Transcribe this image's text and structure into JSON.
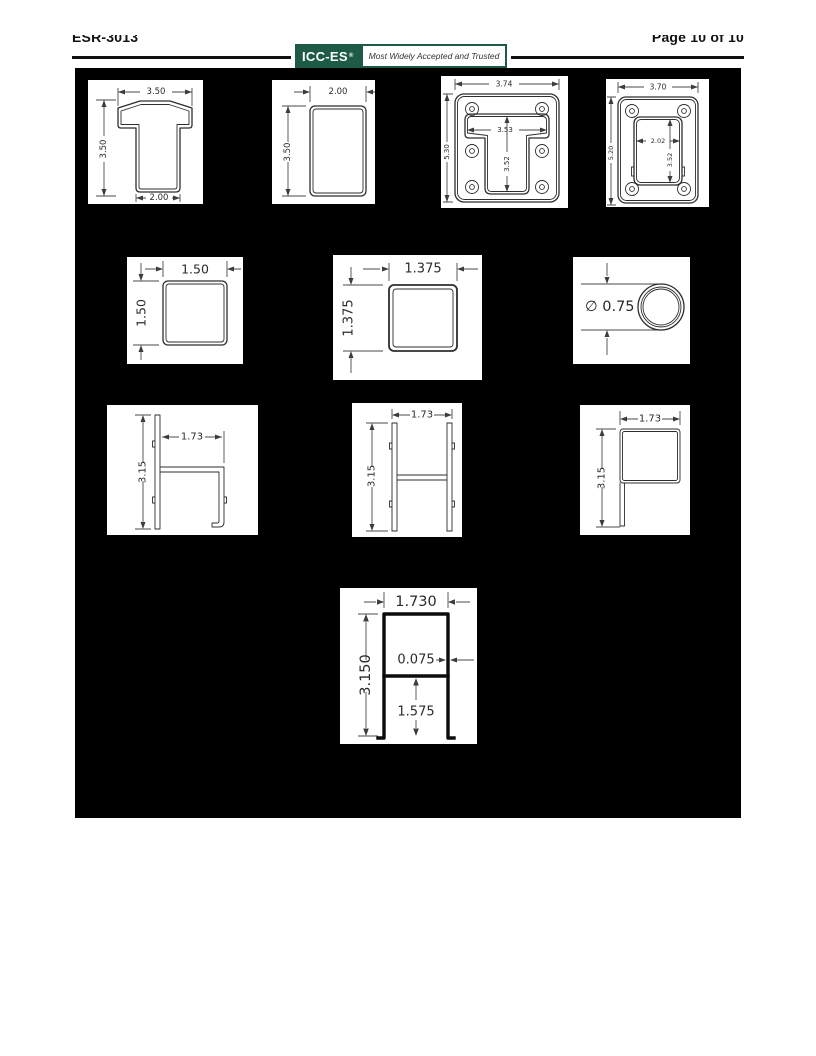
{
  "header": {
    "report_number": "ESR-3013",
    "page_label": "Page 10 of 10",
    "logo_text": "ICC-ES",
    "logo_reg": "®",
    "logo_tagline": "Most Widely Accepted and Trusted"
  },
  "colors": {
    "logo_green": "#1d5b46",
    "figure_background": "#000000"
  },
  "figures": {
    "tee": {
      "width": "3.50",
      "height": "3.50",
      "base": "2.00"
    },
    "rect_tube": {
      "width": "2.00",
      "height": "3.50"
    },
    "plate6": {
      "width": "3.74",
      "height": "5.30",
      "slot_width": "3.53",
      "slot_depth": "3.52"
    },
    "plate4": {
      "width": "3.70",
      "height": "5.20",
      "cutout_width": "2.02",
      "cutout_height": "3.52"
    },
    "sq150": {
      "width": "1.50",
      "height": "1.50"
    },
    "sq1375": {
      "width": "1.375",
      "height": "1.375"
    },
    "round": {
      "diameter": "∅ 0.75"
    },
    "h_small": {
      "width": "1.73",
      "height": "3.15"
    },
    "H_small": {
      "width": "1.73",
      "height": "3.15"
    },
    "p_small": {
      "width": "1.73",
      "height": "3.15"
    },
    "h_thick": {
      "width": "1.730",
      "height": "3.150",
      "wall": "0.075",
      "leg": "1.575"
    }
  }
}
